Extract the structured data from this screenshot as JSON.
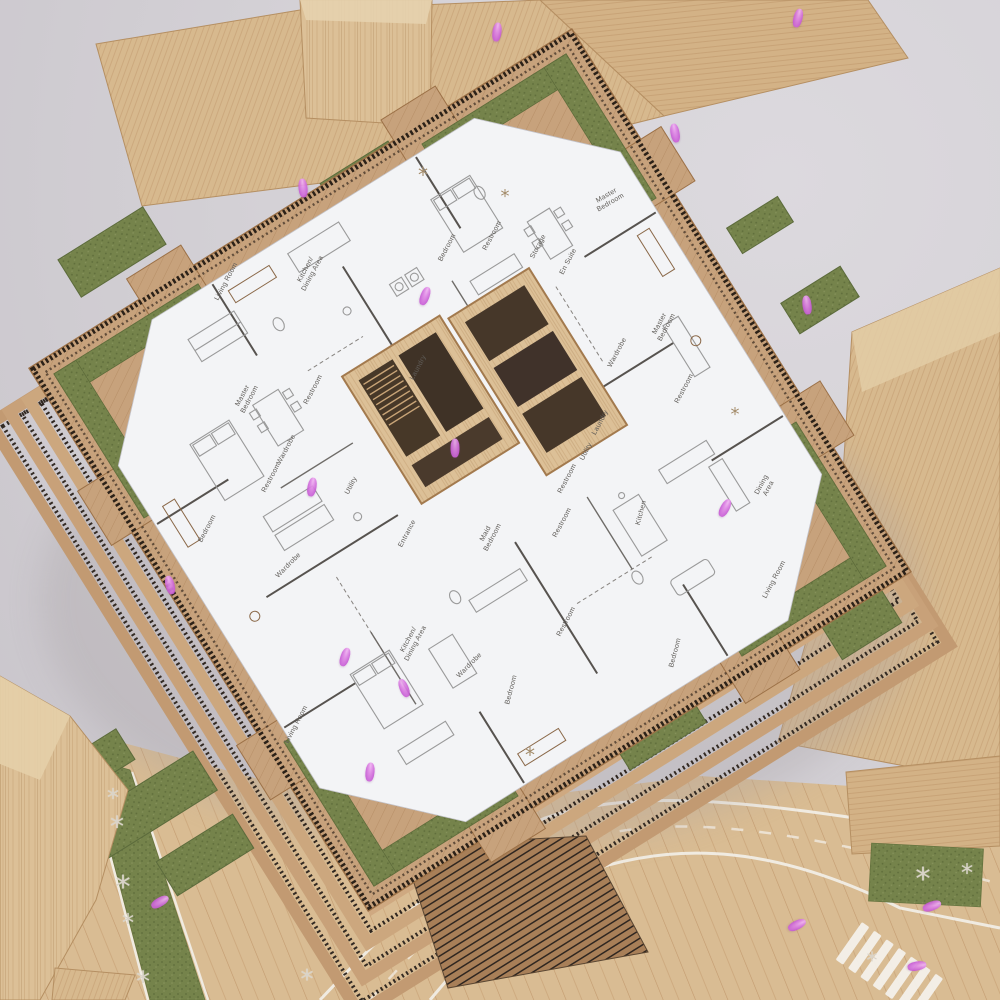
{
  "colors": {
    "background_gray": "#d4d1d6",
    "wood_light": "#dcc097",
    "wood_mid": "#c9a37c",
    "deck_wood": "#c7a27c",
    "moss_green": "#75834b",
    "plan_white": "#f3f4f6",
    "railing_dark": "#2b2118",
    "figure_pink": "#d877dd",
    "road_line_white": "#f2efe9"
  },
  "rooms": [
    {
      "label": "Living Room",
      "x": 227,
      "y": 282,
      "r": -62
    },
    {
      "label": "Kitchen/\nDining Area",
      "x": 310,
      "y": 272,
      "r": -62
    },
    {
      "label": "Master\nBedroom",
      "x": 247,
      "y": 398,
      "r": -62
    },
    {
      "label": "Restroom",
      "x": 314,
      "y": 390,
      "r": -62
    },
    {
      "label": "Laundry",
      "x": 419,
      "y": 368,
      "r": -62
    },
    {
      "label": "Wardrobe",
      "x": 287,
      "y": 450,
      "r": -62
    },
    {
      "label": "Restroom",
      "x": 272,
      "y": 478,
      "r": -62
    },
    {
      "label": "Bedroom",
      "x": 448,
      "y": 248,
      "r": -62
    },
    {
      "label": "Restroom",
      "x": 493,
      "y": 236,
      "r": -62
    },
    {
      "label": "Storage",
      "x": 539,
      "y": 247,
      "r": -62
    },
    {
      "label": "En Suite",
      "x": 569,
      "y": 262,
      "r": -62
    },
    {
      "label": "Master\nBedroom",
      "x": 609,
      "y": 200,
      "r": -30
    },
    {
      "label": "Master\nBedroom",
      "x": 664,
      "y": 326,
      "r": -62
    },
    {
      "label": "Wardrobe",
      "x": 618,
      "y": 353,
      "r": -62
    },
    {
      "label": "Restroom",
      "x": 685,
      "y": 389,
      "r": -62
    },
    {
      "label": "Kitchen",
      "x": 642,
      "y": 513,
      "r": -75
    },
    {
      "label": "Dining\nArea",
      "x": 766,
      "y": 487,
      "r": -62
    },
    {
      "label": "Living Room",
      "x": 775,
      "y": 580,
      "r": -62
    },
    {
      "label": "Bedroom",
      "x": 676,
      "y": 653,
      "r": -75
    },
    {
      "label": "Laundry",
      "x": 601,
      "y": 423,
      "r": -62
    },
    {
      "label": "Utility",
      "x": 587,
      "y": 452,
      "r": -62
    },
    {
      "label": "Restroom",
      "x": 568,
      "y": 479,
      "r": -62
    },
    {
      "label": "Restroom",
      "x": 563,
      "y": 523,
      "r": -62
    },
    {
      "label": "Maid\nBedroom",
      "x": 490,
      "y": 536,
      "r": -62
    },
    {
      "label": "Entrance",
      "x": 408,
      "y": 534,
      "r": -62
    },
    {
      "label": "Utility",
      "x": 352,
      "y": 486,
      "r": -62
    },
    {
      "label": "Bedroom",
      "x": 208,
      "y": 529,
      "r": -62
    },
    {
      "label": "Wardrobe",
      "x": 289,
      "y": 566,
      "r": -45
    },
    {
      "label": "Kitchen/\nDining Area",
      "x": 413,
      "y": 642,
      "r": -62
    },
    {
      "label": "Wardrobe",
      "x": 470,
      "y": 666,
      "r": -45
    },
    {
      "label": "Bedroom",
      "x": 512,
      "y": 690,
      "r": -75
    },
    {
      "label": "Restroom",
      "x": 567,
      "y": 622,
      "r": -62
    },
    {
      "label": "Living Room",
      "x": 297,
      "y": 725,
      "r": -62
    }
  ],
  "figures": [
    {
      "x": 497,
      "y": 32,
      "r": 8
    },
    {
      "x": 675,
      "y": 133,
      "r": -10
    },
    {
      "x": 798,
      "y": 18,
      "r": 14
    },
    {
      "x": 303,
      "y": 188,
      "r": -6
    },
    {
      "x": 425,
      "y": 296,
      "r": 20
    },
    {
      "x": 170,
      "y": 585,
      "r": -14
    },
    {
      "x": 312,
      "y": 487,
      "r": 10
    },
    {
      "x": 725,
      "y": 508,
      "r": 28
    },
    {
      "x": 807,
      "y": 305,
      "r": -8
    },
    {
      "x": 345,
      "y": 657,
      "r": 18
    },
    {
      "x": 404,
      "y": 688,
      "r": -22
    },
    {
      "x": 370,
      "y": 772,
      "r": 6
    },
    {
      "x": 932,
      "y": 906,
      "r": 70
    },
    {
      "x": 797,
      "y": 925,
      "r": 64
    },
    {
      "x": 917,
      "y": 966,
      "r": 80
    },
    {
      "x": 160,
      "y": 902,
      "r": 60
    },
    {
      "x": 455,
      "y": 448,
      "r": 0
    }
  ],
  "trees": [
    {
      "x": 113,
      "y": 798,
      "s": 24,
      "variant": "pale"
    },
    {
      "x": 117,
      "y": 827,
      "s": 28,
      "variant": "pale"
    },
    {
      "x": 123,
      "y": 888,
      "s": 30,
      "variant": "pale"
    },
    {
      "x": 128,
      "y": 923,
      "s": 24,
      "variant": "pale"
    },
    {
      "x": 143,
      "y": 982,
      "s": 28,
      "variant": "pale"
    },
    {
      "x": 307,
      "y": 980,
      "s": 26,
      "variant": "pale"
    },
    {
      "x": 923,
      "y": 880,
      "s": 30,
      "variant": "pale"
    },
    {
      "x": 967,
      "y": 873,
      "s": 24,
      "variant": "pale"
    },
    {
      "x": 872,
      "y": 962,
      "s": 22,
      "variant": "pale"
    },
    {
      "x": 423,
      "y": 175,
      "s": 20,
      "variant": "brown"
    },
    {
      "x": 505,
      "y": 197,
      "s": 18,
      "variant": "brown"
    },
    {
      "x": 735,
      "y": 415,
      "s": 18,
      "variant": "brown"
    },
    {
      "x": 530,
      "y": 755,
      "s": 20,
      "variant": "brown"
    }
  ]
}
